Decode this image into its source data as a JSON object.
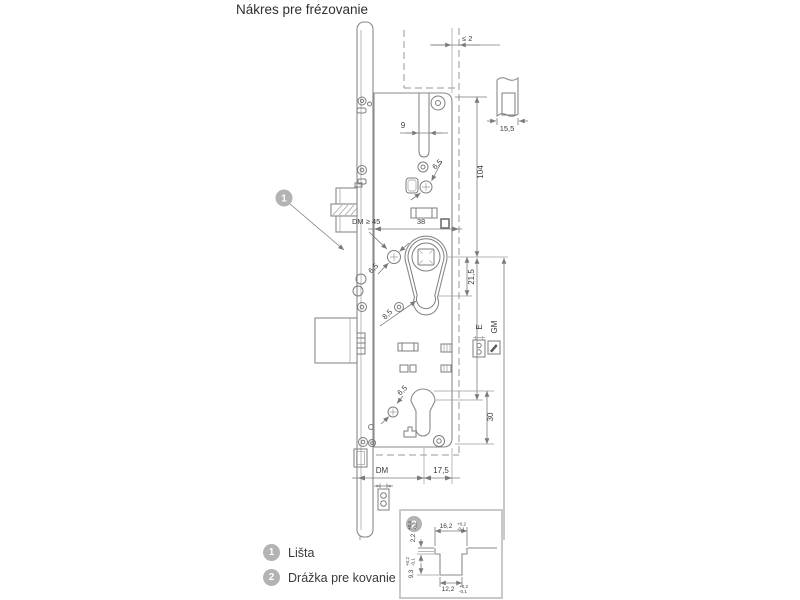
{
  "title": "Nákres pre frézovanie",
  "legend": [
    {
      "num": "1",
      "label": "Lišta"
    },
    {
      "num": "2",
      "label": "Drážka pre kovanie"
    }
  ],
  "callouts": {
    "c1": "1",
    "c2": "2"
  },
  "dims": {
    "gap": "≤ 2",
    "plate": "15,5",
    "slot": "9",
    "d65_top": "6,5",
    "h104": "104",
    "dm_min": "DM ≥ 45",
    "w38": "38",
    "v215": "21,5",
    "d65_mid": "6,5",
    "d85": "8,5",
    "e": "E",
    "gm": "GM",
    "d65_bot": "6,5",
    "v30": "30",
    "dm": "DM",
    "w175": "17,5"
  },
  "detail": {
    "w_top": "16,2",
    "w_top_tp": "+0,2",
    "w_top_tm": "-0,1",
    "d_step": "2,2",
    "d_step_tp": "+0,2",
    "d_step_tm": "-0,1",
    "w_bot": "12,2",
    "w_bot_tp": "+0,2",
    "w_bot_tm": "-0,1",
    "d_full": "9,3",
    "d_full_tp": "+0,2",
    "d_full_tm": "-0,1"
  },
  "colors": {
    "line": "#8a8a8a",
    "dimension": "#7a7a7a",
    "text": "#3c3c3c",
    "callout": "#b3b3b3",
    "detail_border": "#c9c9c9"
  }
}
